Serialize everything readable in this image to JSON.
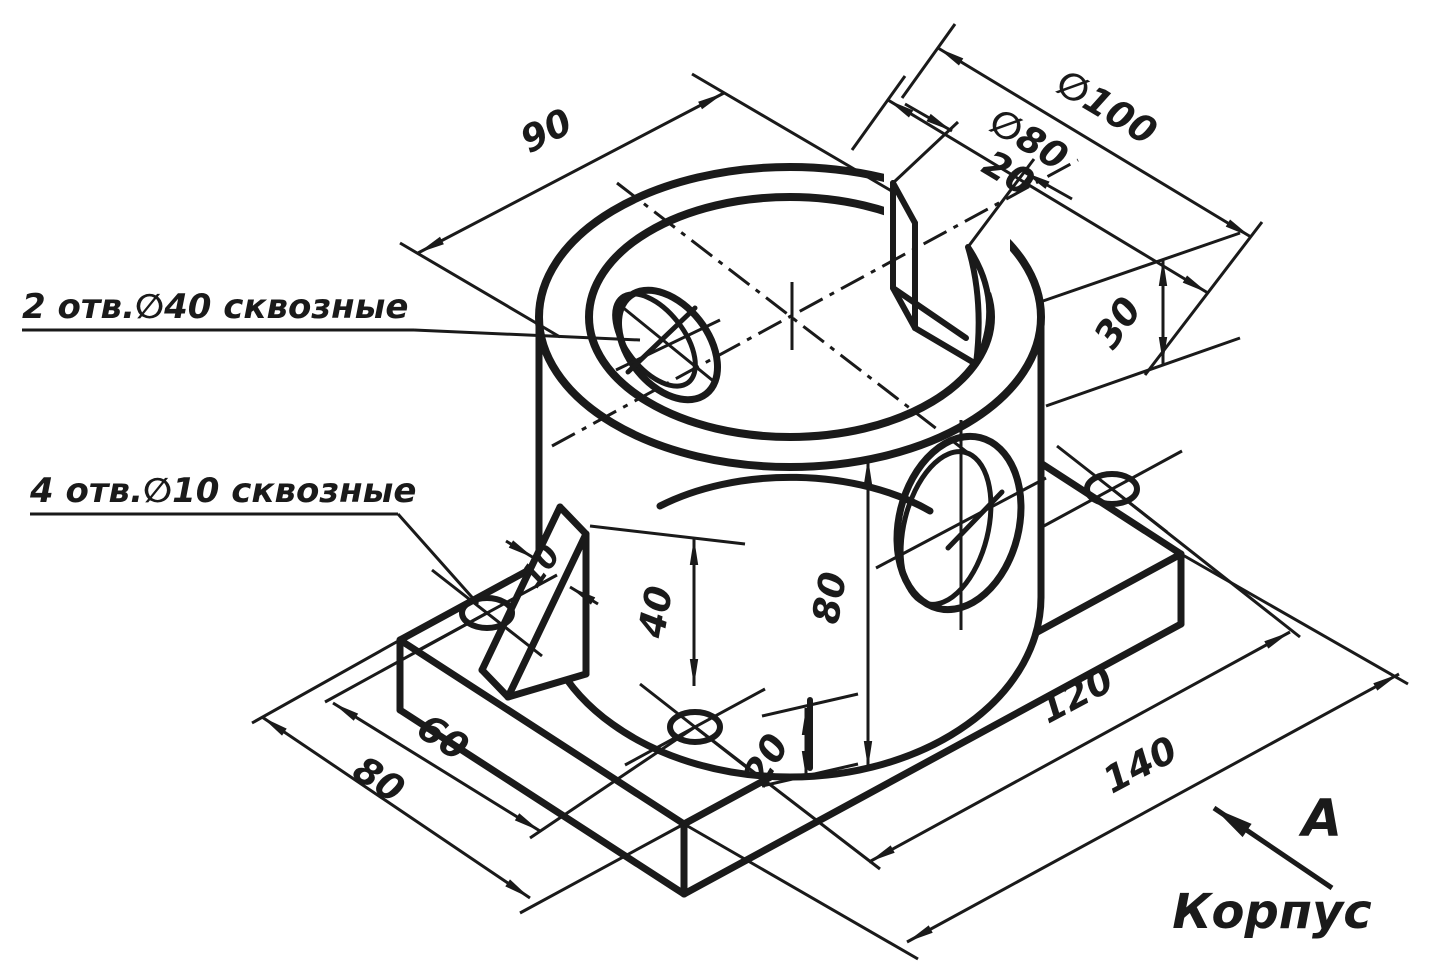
{
  "title": {
    "part_name": "Корпус",
    "view_label": "A"
  },
  "annotations": {
    "holes_d40": "2 отв.∅40 сквозные",
    "holes_d10": "4 отв.∅10 сквозные"
  },
  "dimensions": {
    "width_90": "90",
    "dia_outer": "∅100",
    "dia_inner": "∅80",
    "slot_width": "20",
    "slot_depth": "30",
    "cyl_height": "80",
    "rib_height": "40",
    "rib_thickness": "10",
    "plate_thickness": "20",
    "hole_span_w": "60",
    "plate_width": "80",
    "hole_span_l": "120",
    "plate_length": "140"
  },
  "colors": {
    "ink": "#1a1a1a",
    "paper": "#ffffff"
  }
}
